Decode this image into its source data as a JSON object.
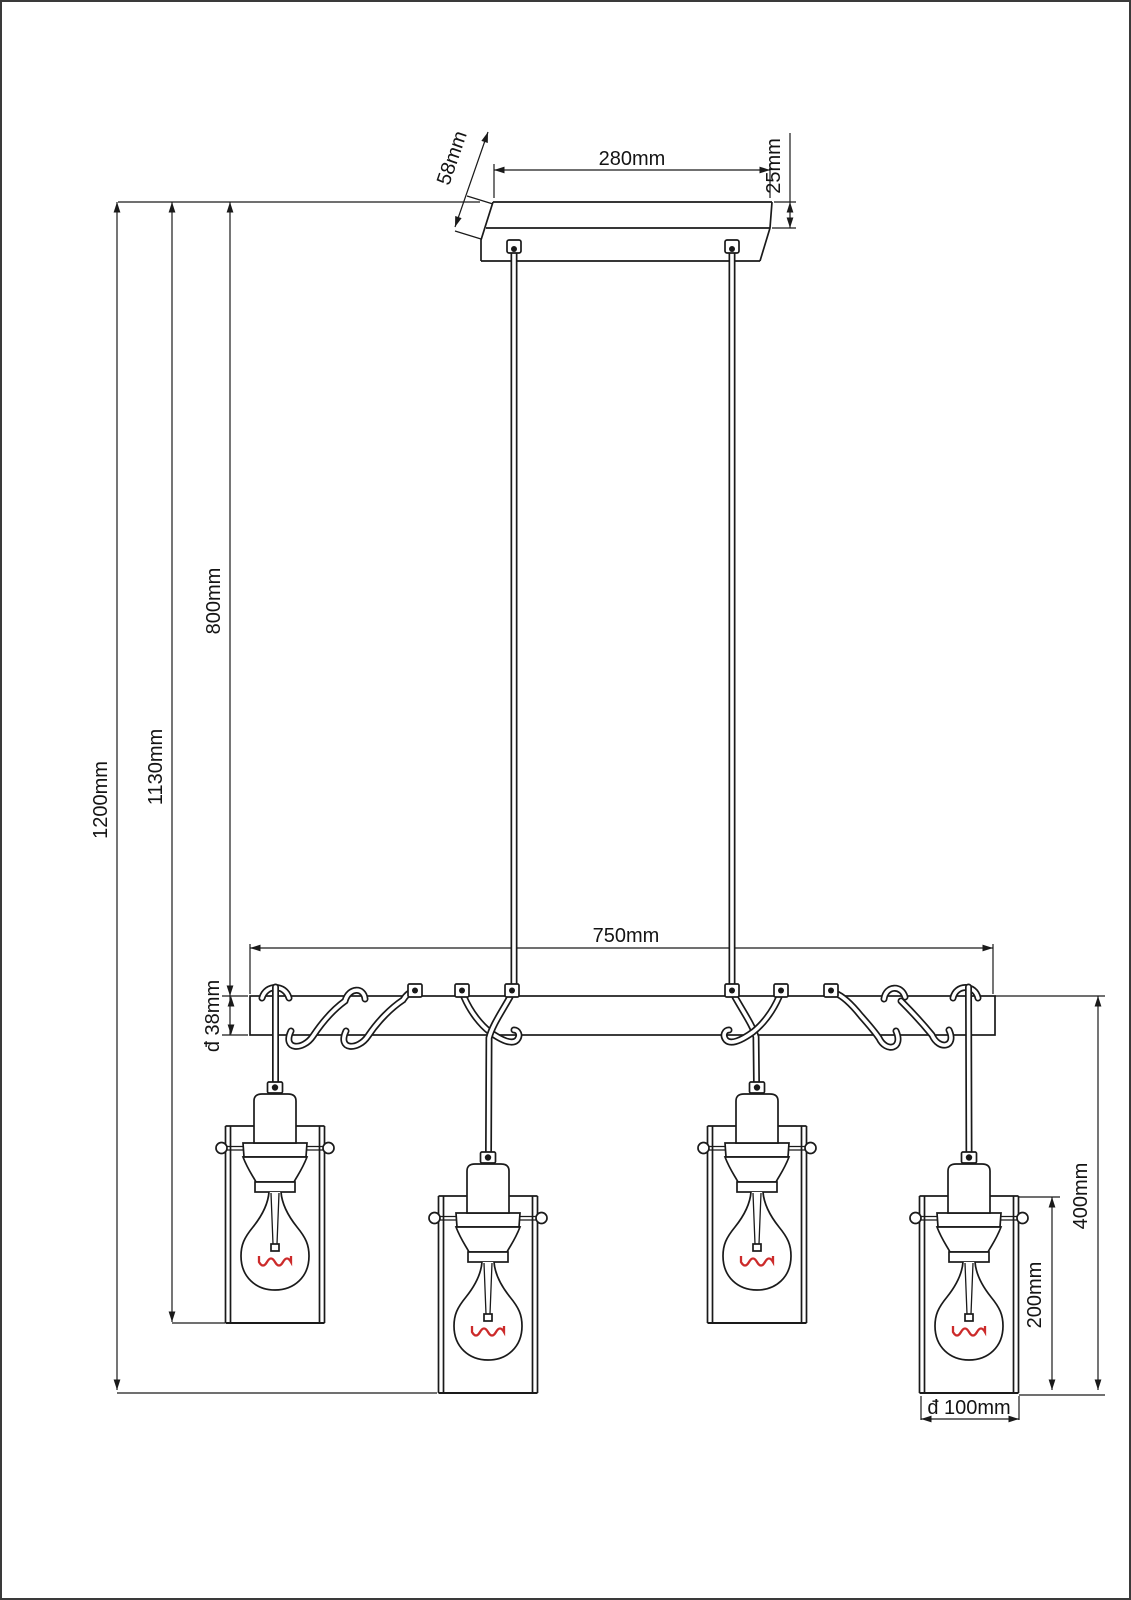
{
  "colors": {
    "line": "#1a1a1a",
    "filament": "#cc2b2b"
  },
  "dimensions": {
    "canopy_width": "280mm",
    "canopy_depth": "58mm",
    "canopy_thickness": "25mm",
    "suspension_drop": "800mm",
    "drop_to_upper_shades": "1130mm",
    "overall_drop": "1200mm",
    "beam_length": "750mm",
    "beam_diameter": "đ 38mm",
    "shade_assembly_drop": "400mm",
    "shade_height": "200mm",
    "shade_diameter": "đ 100mm"
  }
}
